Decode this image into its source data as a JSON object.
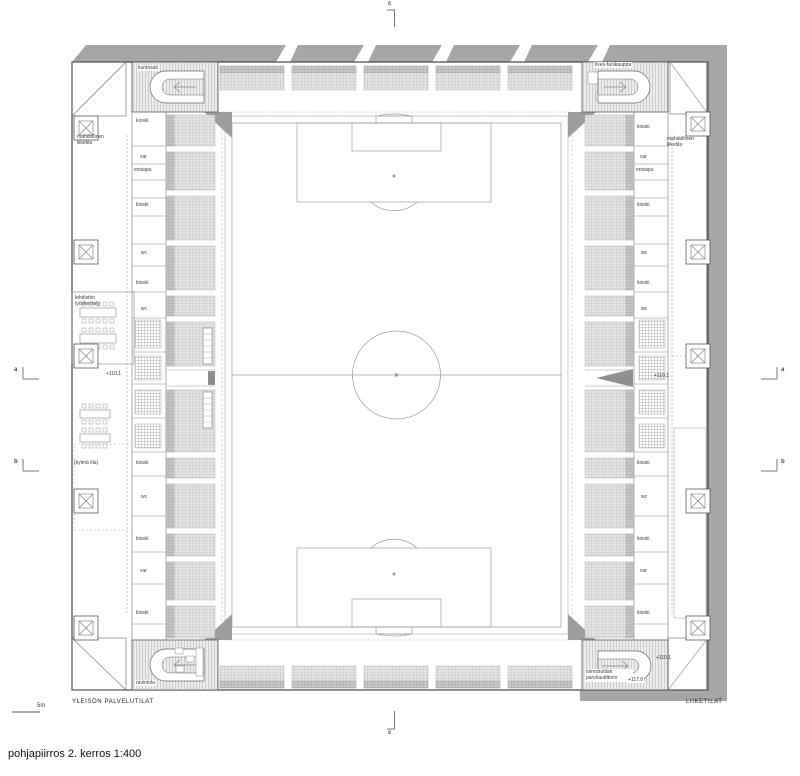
{
  "title": "pohjapiirros 2. kerros 1:400",
  "scale_label": "5m",
  "zones": {
    "public": "YLEISÖN PALVELUTILAT",
    "commercial": "LIIKETILAT"
  },
  "sections": {
    "a": "a",
    "b": "b",
    "c": "c"
  },
  "elevations": {
    "left": "+110.1",
    "right": "+110.1",
    "right_bottom": "+110.1",
    "auditorium": "+117.0"
  },
  "corners": {
    "top_left": "kuntosali",
    "top_right": "ilves-fanikauppa",
    "bottom_left": "ravintola",
    "bottom_right": "toimistotilan parvi/auditorio"
  },
  "outer": {
    "left_retail": "mahdollinen liiketila",
    "press": "lehdistön työskentely",
    "cold": "(kylmä tila)",
    "right_retail": "mahdollinen liiketila"
  },
  "left_rooms": [
    "kioski",
    "var",
    "ensiapu",
    "kioski",
    "wc",
    "kioski",
    "wc",
    "kioski",
    "wc",
    "kioski",
    "var",
    "kioski"
  ],
  "right_rooms": [
    "kioski",
    "var",
    "ensiapu",
    "kioski",
    "wc",
    "kioski",
    "wc",
    "kioski",
    "wc",
    "kioski",
    "var",
    "kioski"
  ]
}
